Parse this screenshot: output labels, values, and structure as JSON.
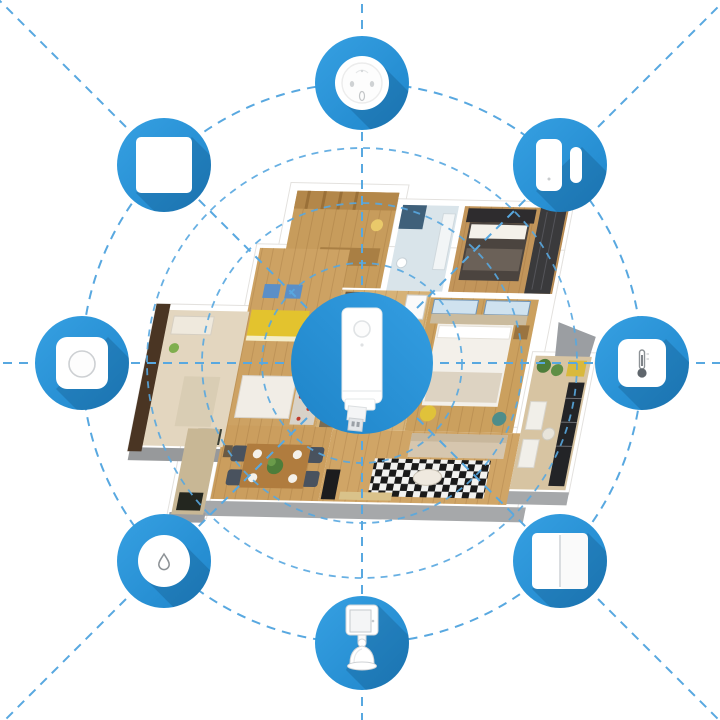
{
  "meta": {
    "description": "Smart home hub ecosystem diagram over a 3D apartment floor plan",
    "background": "#FFFFFF"
  },
  "palette": {
    "primary_blue": "#2795DC",
    "icon_gradient_top": "#36A0E2",
    "icon_gradient_bottom": "#1F86CB",
    "long_shadow": "rgba(0,25,50,0.16)",
    "dash_blue": "#58A8E0",
    "device_white": "#FFFFFF",
    "device_outline_gray": "#D2D5D8",
    "wall_gray": "#A6A8AA",
    "wood_floor": "#CDA263"
  },
  "hub": {
    "id": "smart-home-hub",
    "label": "Smart home USB hub gateway",
    "cx": 362,
    "cy": 363,
    "radius": 71
  },
  "network": {
    "ring_radius": 280,
    "ripple_radii": [
      100,
      160,
      215
    ],
    "radial_line_count": 8,
    "line_style": "dashed"
  },
  "devices": [
    {
      "id": "smart-plug",
      "label": "Smart plug (round socket)",
      "angle_deg": 90
    },
    {
      "id": "door-window-sensor",
      "label": "Door and window sensor",
      "angle_deg": 45
    },
    {
      "id": "temperature-humidity-sensor",
      "label": "Temperature and humidity sensor",
      "angle_deg": 0
    },
    {
      "id": "wall-switch-double",
      "label": "Double rocker wall switch",
      "angle_deg": 315
    },
    {
      "id": "motion-sensor",
      "label": "Motion sensor on stand",
      "angle_deg": 270
    },
    {
      "id": "water-leak-sensor",
      "label": "Water leak sensor",
      "angle_deg": 225
    },
    {
      "id": "wireless-mini-switch",
      "label": "Wireless mini switch button",
      "angle_deg": 180
    },
    {
      "id": "wall-switch-single",
      "label": "Single wall switch",
      "angle_deg": 135
    }
  ],
  "floorplan": {
    "label": "3D isometric apartment floor plan",
    "rooms": [
      {
        "name": "study",
        "floor": "#C79C5C"
      },
      {
        "name": "bathroom",
        "floor": "#D9E4EA"
      },
      {
        "name": "bedroom-main",
        "floor": "#C2955A"
      },
      {
        "name": "kids-room",
        "floor": "#CDA263"
      },
      {
        "name": "corridor",
        "floor": "#D6B277"
      },
      {
        "name": "bedroom-second",
        "floor": "#CBA05E"
      },
      {
        "name": "living-room",
        "floor": "#D0A566"
      },
      {
        "name": "dining-area",
        "floor": "#CB9E5E"
      },
      {
        "name": "balcony",
        "floor": "#D7C4A2"
      },
      {
        "name": "hallway",
        "floor": "#E3D6BF"
      }
    ]
  }
}
